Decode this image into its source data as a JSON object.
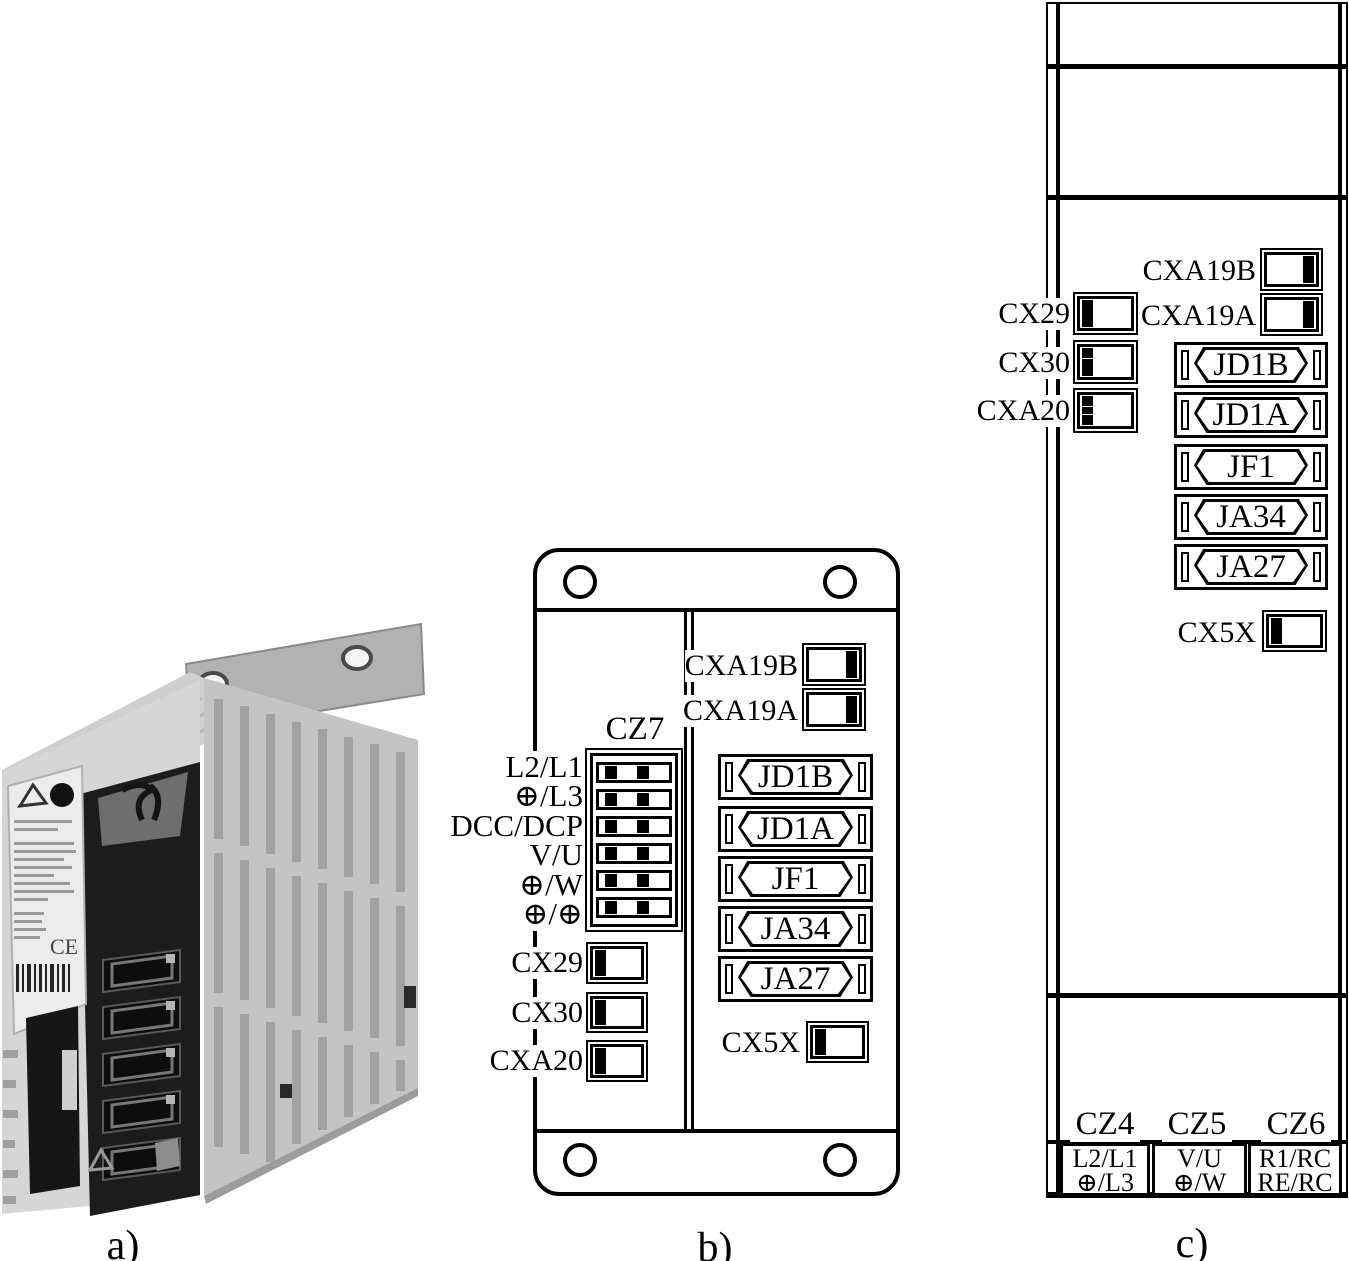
{
  "background": "#ffffff",
  "line_color": "#000000",
  "captions": {
    "a": "a)",
    "b": "b)",
    "c": "c)"
  },
  "photo": {
    "ce_mark": "CE"
  },
  "panel_b": {
    "cz7_label": "CZ7",
    "terminal_rows": [
      "L2/L1",
      "⊕/L3",
      "DCC/DCP",
      "V/U",
      "⊕/W",
      "⊕/⊕"
    ],
    "connectors": {
      "cxa19b": "CXA19B",
      "cxa19a": "CXA19A",
      "cx29": "CX29",
      "cx30": "CX30",
      "cxa20": "CXA20",
      "cx5x": "CX5X"
    },
    "dsub": [
      "JD1B",
      "JD1A",
      "JF1",
      "JA34",
      "JA27"
    ]
  },
  "panel_c": {
    "connectors": {
      "cxa19b": "CXA19B",
      "cxa19a": "CXA19A",
      "cx29": "CX29",
      "cx30": "CX30",
      "cxa20": "CXA20",
      "cx5x": "CX5X"
    },
    "dsub": [
      "JD1B",
      "JD1A",
      "JF1",
      "JA34",
      "JA27"
    ],
    "terminals": [
      {
        "label": "CZ4",
        "line1": "L2/L1",
        "line2": "⊕/L3"
      },
      {
        "label": "CZ5",
        "line1": "V/U",
        "line2": "⊕/W"
      },
      {
        "label": "CZ6",
        "line1": "R1/RC",
        "line2": "RE/RC"
      }
    ]
  }
}
